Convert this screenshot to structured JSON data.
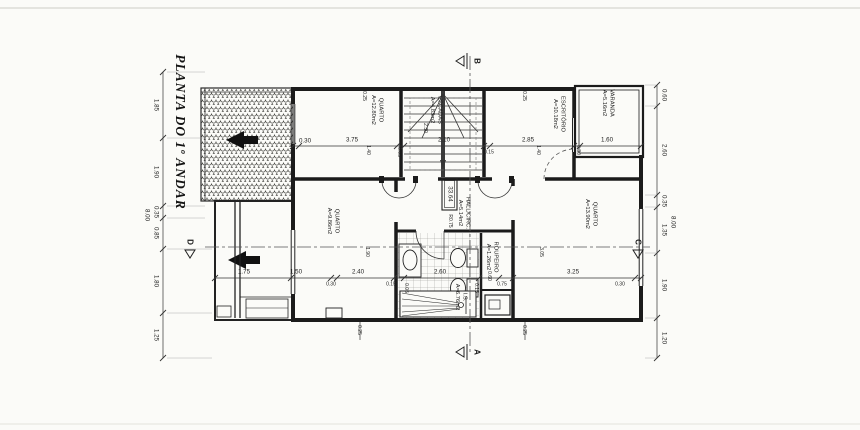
{
  "drawing": {
    "title": "PLANTA DO 1º ANDAR",
    "level": "33.64",
    "door_radius": "R0.75"
  },
  "markers": {
    "a": "A",
    "b": "B",
    "c": "C",
    "d": "D"
  },
  "rooms": {
    "quarto_tl": {
      "name": "QUARTO",
      "area": "A=12.80m2"
    },
    "escadas": {
      "name": "ESCADAS",
      "area": "A=4.83m2"
    },
    "escritorio": {
      "name": "ESCRITÓRIO",
      "area": "A=10.18m2"
    },
    "varanda": {
      "name": "VARANDA",
      "area": "A=5.16m2"
    },
    "quarto_l": {
      "name": "QUARTO",
      "area": "A=9.86m2"
    },
    "hall": {
      "name": "HALL/CIRC.",
      "area": "A=5.14m2"
    },
    "is": {
      "name": "I.S.",
      "area": "A=6.76m2"
    },
    "roupeiro": {
      "name": "ROUPEIRO",
      "area": "A=1.26m2"
    },
    "quarto_r": {
      "name": "QUARTO",
      "area": "A=13.90m2"
    }
  },
  "dims": {
    "left": [
      "1.85",
      "1.90",
      "0.35",
      "0.85",
      "1.80",
      "1.25"
    ],
    "left_total": "8.00",
    "right": [
      "0.60",
      "2.60",
      "0.35",
      "1.35",
      "1.90",
      "1.20"
    ],
    "right_total": "8.00",
    "top": [
      "0.30",
      "3.75",
      "0.05",
      "2.10",
      "0.15",
      "2.85",
      "0.30",
      "1.60"
    ],
    "top_extra": [
      "0.25",
      "0.25",
      "1.40",
      "1.40"
    ],
    "mid": [
      "1.75",
      "1.50",
      "0.30",
      "2.40",
      "0.15",
      "2.60",
      "0.60",
      "0.75",
      "3.25",
      "0.30"
    ],
    "bottom": [
      "0.25",
      "0.25"
    ],
    "interior": [
      "1.90",
      "3.05",
      "2.30",
      "0.05",
      "0.15"
    ]
  }
}
